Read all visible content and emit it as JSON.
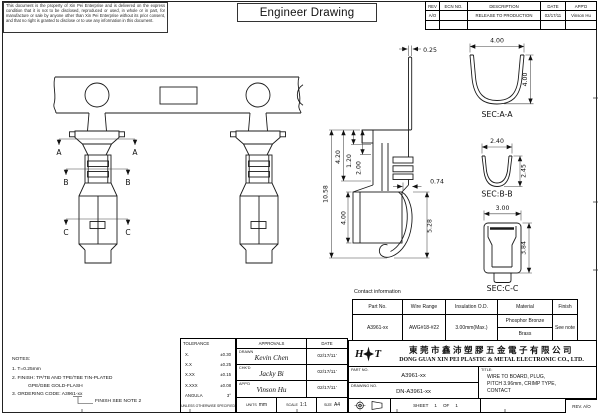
{
  "sheet": {
    "disclaimer": "This document is the property of Xin Pei Enterprise and is delivered on the express condition that it is not to be disclosed, reproduced or used, in whole or in part, for manufacture or sale by anyone other than Xin Pei Enterprise without its prior consent, and that no right is granted to disclose or to use any information in this document.",
    "title": "Engineer Drawing"
  },
  "revision_table": {
    "headers": [
      "REV",
      "ECN NO.",
      "DESCRIPTION",
      "DATE",
      "APP'D"
    ],
    "row": {
      "rev": "A/O",
      "ecn": "",
      "description": "RELEASE TO PRODUCTION",
      "date": "02/17/11",
      "approved": "Vinson Hu"
    }
  },
  "drawing": {
    "section_markers": {
      "a": "A",
      "b": "B",
      "c": "C"
    },
    "dims": {
      "blade_thickness": "0.25",
      "overall_height": "10.58",
      "upper_height": "4.20",
      "step_1": "1.20",
      "step_2": "2.00",
      "box_height": "4.00",
      "lance_offset": "0.74",
      "lance_height": "5.28"
    },
    "sections": {
      "aa": {
        "label": "SEC:A-A",
        "width": "4.00",
        "height": "4.00"
      },
      "bb": {
        "label": "SEC:B-B",
        "width": "2.40",
        "height": "2.45"
      },
      "cc": {
        "label": "SEC:C-C",
        "width": "3.00",
        "height": "3.84"
      }
    }
  },
  "contact_info": {
    "title": "Contact information",
    "headers": [
      "Part No.",
      "Wire Range",
      "Insulation O.D.",
      "Material",
      "Finish"
    ],
    "row": {
      "part_no": "A3961-xx",
      "wire_range": "AWG#18-#22",
      "insulation_od": "3.00mm(Max.)",
      "material_top": "Phosphor Bronze",
      "material_bottom": "Brass",
      "finish": "See note"
    }
  },
  "notes": {
    "heading": "NOTES:",
    "n1": "1. T=0.25mm",
    "n2": "2. FINISH: TP/TB AND TPE/TBE TIN-PLATED",
    "n3": "GPE/GBE GOLD-FLASH",
    "n4": "3. ORDERING CODE: A3961-xx",
    "callout": "FINISH SEE NOTE 2"
  },
  "tolerance": {
    "title": "TOLERANCE",
    "rows": [
      {
        "label": "X.",
        "value": "±0.30"
      },
      {
        "label": "X.X",
        "value": "±0.25"
      },
      {
        "label": "X.XX",
        "value": "±0.15"
      },
      {
        "label": "X.XXX",
        "value": "±0.08"
      },
      {
        "label": "ANGULA",
        "value": "3°"
      }
    ],
    "footer": "UNLESS OTHERWISE SPECIFIED"
  },
  "approvals": {
    "title": "APPROVALS",
    "date_header": "DATE",
    "rows": [
      {
        "role": "DRAWN",
        "name": "Kevin Chen",
        "date": "02/17/11'"
      },
      {
        "role": "CHK'D",
        "name": "Jacky Bi",
        "date": "02/17/11'"
      },
      {
        "role": "APP'D",
        "name": "Vinson Hu",
        "date": "02/17/11'"
      }
    ],
    "units_label": "UNITS",
    "units": "mm",
    "scale_label": "SCALE",
    "scale": "1:1",
    "size_label": "SIZE",
    "size": "A4"
  },
  "title_block": {
    "logo_left": "H",
    "logo_right": "T",
    "company_cn": "東莞市鑫沛塑膠五金電子有限公司",
    "company_en": "DONG GUAN XIN PEI PLASTIC & METAL ELECTRONIC CO., LTD.",
    "part_no_label": "PART NO.",
    "part_no": "A3961-xx",
    "drawing_no_label": "DRAWING NO.",
    "drawing_no": "DN-A3961-xx",
    "title_label": "TITLE:",
    "title_line1": "WIRE TO BOARD, PLUG,",
    "title_line2": "PITCH 3.96mm, CRIMP TYPE,",
    "title_line3": "CONTACT",
    "sheet_label": "SHEET",
    "sheet_number": "1",
    "of_label": "OF",
    "sheet_total": "1",
    "revision": "REV. A/O"
  }
}
